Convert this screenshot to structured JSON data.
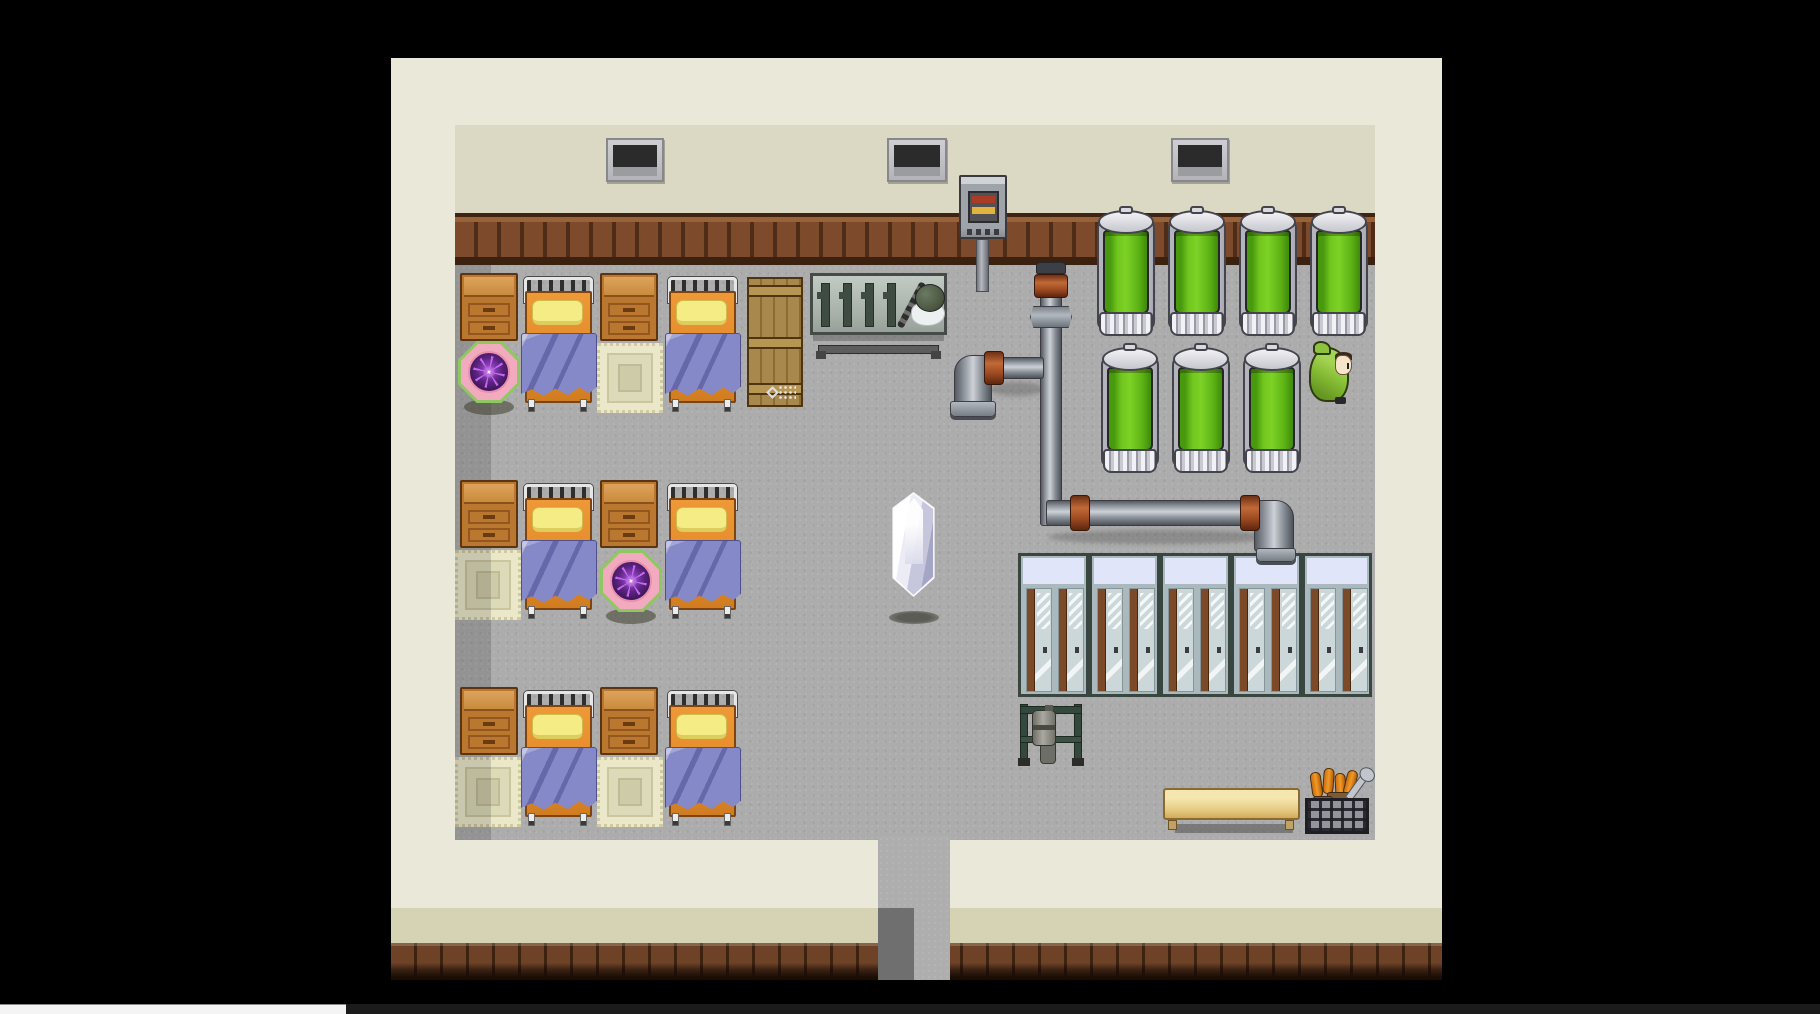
{
  "meta": {
    "app": "rpg-game-viewport",
    "scene": "dormitory-laboratory-room",
    "view": "top-down-2d-pixel-art"
  },
  "viewport": {
    "width": 1820,
    "height": 1014
  },
  "palette": {
    "bg": "#000000",
    "wall_outer": "#e9e8d9",
    "wall_inner": "#dbd9c4",
    "wainscot": "#7d4b2c",
    "floor": "#acacac",
    "band_khaki": "#d6d3b5",
    "baseboard": "#6e4226",
    "corridor_shadow": "#6f6f6f",
    "window_dark": "#2b2b2b",
    "tank_green": "#7dd226",
    "locker_body": "#a9b9bd",
    "locker_top": "#e0e5f9",
    "bed_orange": "#e08828",
    "pillow_yellow": "#f6ec86",
    "blanket_purple": "#8689c8",
    "wood": "#b9772f",
    "wood_light": "#dda35c",
    "rug_cream": "#ebe8ca",
    "orb_pink": "#f2aabe",
    "orb_purple": "#5a2480",
    "orb_green": "#8fc862",
    "crystal_dark": "#a5a5c5",
    "cloak_green": "#85bb34",
    "bench_tan": "#e6cc84",
    "basket_orange": "#f29a26",
    "copper": "#c06a38",
    "panel_red": "#a83c26",
    "panel_yellow": "#e3b33f"
  },
  "inventory": {
    "windows": 3,
    "beds": 6,
    "nightstands": 6,
    "rugs": 4,
    "save_orbs": 2,
    "wooden_crates": 1,
    "tool_benches": 1,
    "culture_tanks": 7,
    "lockers": 5,
    "crystals": 1,
    "npcs": 1,
    "wall_panels": 1,
    "benches": 1,
    "scrap_baskets": 1,
    "doorways": 1
  },
  "scene": {
    "entities": [
      {
        "kind": "window",
        "name": "window",
        "x": 606,
        "y": 138,
        "w": 58,
        "h": 44,
        "i": false
      },
      {
        "kind": "window",
        "name": "window",
        "x": 887,
        "y": 138,
        "w": 60,
        "h": 44,
        "i": false
      },
      {
        "kind": "window",
        "name": "window",
        "x": 1171,
        "y": 138,
        "w": 58,
        "h": 44,
        "i": false
      },
      {
        "kind": "machine",
        "name": "wall-control-panel",
        "x": 959,
        "y": 175,
        "w": 48,
        "h": 117,
        "i": true
      },
      {
        "kind": "nightstand",
        "name": "nightstand",
        "x": 460,
        "y": 273,
        "w": 58,
        "h": 68,
        "i": false
      },
      {
        "kind": "nightstand",
        "name": "nightstand",
        "x": 600,
        "y": 273,
        "w": 58,
        "h": 68,
        "i": false
      },
      {
        "kind": "rug",
        "name": "rug",
        "x": 597,
        "y": 343,
        "w": 66,
        "h": 70,
        "i": false
      },
      {
        "kind": "bed",
        "name": "bed",
        "x": 523,
        "y": 277,
        "w": 73,
        "h": 136,
        "i": true
      },
      {
        "kind": "bed",
        "name": "bed",
        "x": 667,
        "y": 277,
        "w": 73,
        "h": 136,
        "i": true
      },
      {
        "kind": "orb",
        "name": "save-point-orb",
        "x": 458,
        "y": 341,
        "w": 62,
        "h": 76,
        "i": true
      },
      {
        "kind": "crate",
        "name": "wooden-crate",
        "x": 747,
        "y": 277,
        "w": 56,
        "h": 130,
        "i": false
      },
      {
        "kind": "workbench",
        "name": "tool-bench",
        "x": 810,
        "y": 273,
        "w": 137,
        "h": 88,
        "i": false
      },
      {
        "kind": "nightstand",
        "name": "nightstand",
        "x": 460,
        "y": 480,
        "w": 58,
        "h": 68,
        "i": false
      },
      {
        "kind": "nightstand",
        "name": "nightstand",
        "x": 600,
        "y": 480,
        "w": 58,
        "h": 68,
        "i": false
      },
      {
        "kind": "rug",
        "name": "rug",
        "x": 455,
        "y": 550,
        "w": 66,
        "h": 70,
        "i": false
      },
      {
        "kind": "bed",
        "name": "bed",
        "x": 523,
        "y": 484,
        "w": 73,
        "h": 136,
        "i": true
      },
      {
        "kind": "bed",
        "name": "bed",
        "x": 667,
        "y": 484,
        "w": 73,
        "h": 136,
        "i": true
      },
      {
        "kind": "orb",
        "name": "save-point-orb",
        "x": 600,
        "y": 550,
        "w": 62,
        "h": 76,
        "i": true
      },
      {
        "kind": "nightstand",
        "name": "nightstand",
        "x": 460,
        "y": 687,
        "w": 58,
        "h": 68,
        "i": false
      },
      {
        "kind": "nightstand",
        "name": "nightstand",
        "x": 600,
        "y": 687,
        "w": 58,
        "h": 68,
        "i": false
      },
      {
        "kind": "rug",
        "name": "rug",
        "x": 455,
        "y": 757,
        "w": 66,
        "h": 70,
        "i": false
      },
      {
        "kind": "rug",
        "name": "rug",
        "x": 597,
        "y": 757,
        "w": 66,
        "h": 70,
        "i": false
      },
      {
        "kind": "bed",
        "name": "bed",
        "x": 523,
        "y": 691,
        "w": 73,
        "h": 136,
        "i": true
      },
      {
        "kind": "bed",
        "name": "bed",
        "x": 667,
        "y": 691,
        "w": 73,
        "h": 136,
        "i": true
      },
      {
        "kind": "crystal-shadow",
        "name": "crystal-shadow",
        "x": 889,
        "y": 611,
        "w": 50,
        "h": 13,
        "i": false
      },
      {
        "kind": "crystal",
        "name": "crystal-event",
        "x": 885,
        "y": 492,
        "w": 57,
        "h": 105,
        "i": true
      },
      {
        "kind": "tank",
        "name": "culture-tank",
        "x": 1095,
        "y": 208,
        "w": 62,
        "h": 132,
        "i": true
      },
      {
        "kind": "tank",
        "name": "culture-tank",
        "x": 1166,
        "y": 208,
        "w": 62,
        "h": 132,
        "i": true
      },
      {
        "kind": "tank",
        "name": "culture-tank",
        "x": 1237,
        "y": 208,
        "w": 62,
        "h": 132,
        "i": true
      },
      {
        "kind": "tank",
        "name": "culture-tank",
        "x": 1308,
        "y": 208,
        "w": 62,
        "h": 132,
        "i": true
      },
      {
        "kind": "tank",
        "name": "culture-tank",
        "x": 1099,
        "y": 345,
        "w": 62,
        "h": 132,
        "i": true
      },
      {
        "kind": "tank",
        "name": "culture-tank",
        "x": 1170,
        "y": 345,
        "w": 62,
        "h": 132,
        "i": true
      },
      {
        "kind": "tank",
        "name": "culture-tank",
        "x": 1241,
        "y": 345,
        "w": 62,
        "h": 132,
        "i": true
      },
      {
        "kind": "pipe-shadow",
        "name": "pipe-shadow",
        "x": 990,
        "y": 382,
        "w": 54,
        "h": 14,
        "i": false
      },
      {
        "kind": "pipe-shadow",
        "name": "pipe-shadow",
        "x": 1048,
        "y": 530,
        "w": 226,
        "h": 14,
        "i": false
      },
      {
        "kind": "pipe-v",
        "name": "pipe-vertical",
        "x": 1040,
        "y": 268,
        "w": 22,
        "h": 258,
        "i": false
      },
      {
        "kind": "pipe-cap",
        "name": "pipe-cap",
        "x": 1036,
        "y": 262,
        "w": 30,
        "h": 12,
        "i": false
      },
      {
        "kind": "copper-ring",
        "name": "pipe-valve-ring",
        "x": 1034,
        "y": 274,
        "w": 34,
        "h": 24,
        "i": false
      },
      {
        "kind": "hex-fitting",
        "name": "pipe-fitting",
        "x": 1030,
        "y": 306,
        "w": 42,
        "h": 22,
        "i": false
      },
      {
        "kind": "pipe-elbow-tl",
        "name": "pipe-elbow",
        "x": 954,
        "y": 355,
        "w": 38,
        "h": 50,
        "i": false
      },
      {
        "kind": "pipe-h",
        "name": "pipe-horizontal",
        "x": 984,
        "y": 357,
        "w": 60,
        "h": 22,
        "i": false
      },
      {
        "kind": "copper-ring",
        "name": "pipe-coupling",
        "x": 984,
        "y": 351,
        "w": 20,
        "h": 34,
        "i": false
      },
      {
        "kind": "pipe-flange",
        "name": "pipe-flange",
        "x": 950,
        "y": 401,
        "w": 46,
        "h": 16,
        "i": false
      },
      {
        "kind": "pipe-h",
        "name": "pipe-horizontal",
        "x": 1046,
        "y": 500,
        "w": 220,
        "h": 26,
        "i": false
      },
      {
        "kind": "pipe-elbow-tr",
        "name": "pipe-elbow",
        "x": 1254,
        "y": 500,
        "w": 40,
        "h": 52,
        "i": false
      },
      {
        "kind": "copper-ring",
        "name": "pipe-coupling",
        "x": 1070,
        "y": 495,
        "w": 20,
        "h": 36,
        "i": false
      },
      {
        "kind": "copper-ring",
        "name": "pipe-coupling",
        "x": 1240,
        "y": 495,
        "w": 20,
        "h": 36,
        "i": false
      },
      {
        "kind": "pipe-flange",
        "name": "pipe-flange",
        "x": 1256,
        "y": 548,
        "w": 40,
        "h": 14,
        "i": false
      },
      {
        "kind": "locker",
        "name": "locker",
        "x": 1018,
        "y": 553,
        "w": 71,
        "h": 144,
        "i": true
      },
      {
        "kind": "locker",
        "name": "locker",
        "x": 1089,
        "y": 553,
        "w": 71,
        "h": 144,
        "i": true
      },
      {
        "kind": "locker",
        "name": "locker",
        "x": 1160,
        "y": 553,
        "w": 71,
        "h": 144,
        "i": true
      },
      {
        "kind": "locker",
        "name": "locker",
        "x": 1231,
        "y": 553,
        "w": 71,
        "h": 144,
        "i": true
      },
      {
        "kind": "locker",
        "name": "locker",
        "x": 1302,
        "y": 553,
        "w": 70,
        "h": 144,
        "i": true
      },
      {
        "kind": "tool-rack",
        "name": "tool-rack",
        "x": 1018,
        "y": 700,
        "w": 70,
        "h": 68,
        "i": false
      },
      {
        "kind": "bench",
        "name": "wooden-bench",
        "x": 1163,
        "y": 788,
        "w": 137,
        "h": 47,
        "i": false
      },
      {
        "kind": "basket",
        "name": "scrap-basket",
        "x": 1305,
        "y": 770,
        "w": 68,
        "h": 66,
        "i": false
      },
      {
        "kind": "npc",
        "name": "hooded-npc",
        "x": 1309,
        "y": 341,
        "w": 47,
        "h": 63,
        "i": true
      }
    ]
  }
}
